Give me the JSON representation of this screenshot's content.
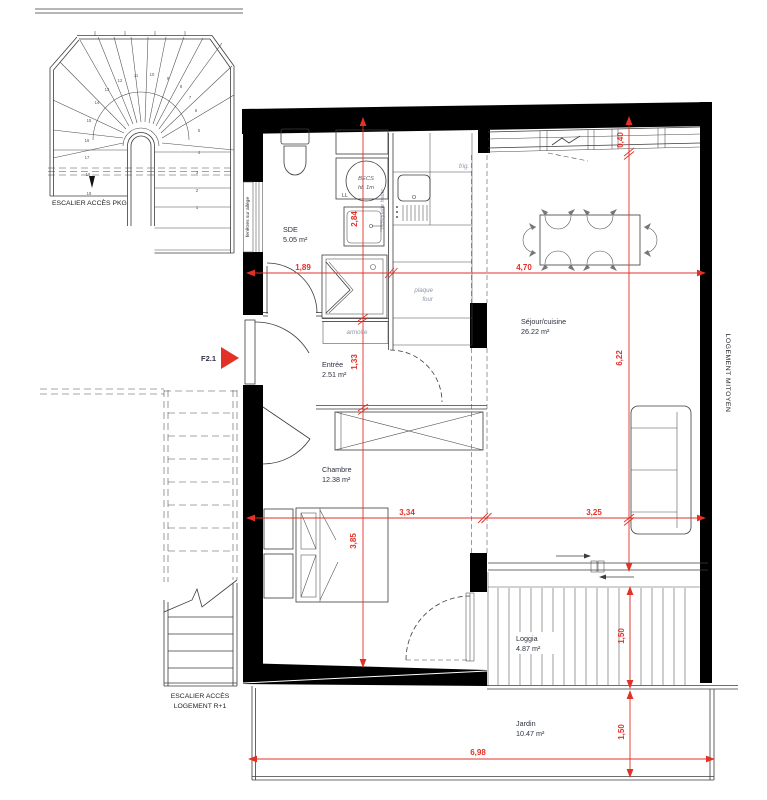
{
  "colors": {
    "dimension": "#e23127",
    "annotation": "#8d95a9",
    "room_text": "#2d3040",
    "wall": "#000000"
  },
  "stairs_pkg": {
    "label": "ESCALIER ACCÈS PKG",
    "steps": [
      "1",
      "2",
      "3",
      "4",
      "5",
      "6",
      "7",
      "8",
      "9",
      "10",
      "11",
      "12",
      "13",
      "14",
      "15",
      "16",
      "17",
      "18",
      "19"
    ]
  },
  "stairs_r1": {
    "label_line1": "ESCALIER ACCÈS",
    "label_line2": "LOGEMENT R+1"
  },
  "unit": {
    "entrance_label": "F2.1",
    "party_wall": "LOGEMENT MITOYEN",
    "window_sill": "fenêtres sur allège"
  },
  "rooms": {
    "sde": {
      "name": "SDE",
      "area": "5.05 m²"
    },
    "entree": {
      "name": "Entrée",
      "area": "2.51 m²"
    },
    "chambre": {
      "name": "Chambre",
      "area": "12.38 m²"
    },
    "sejour": {
      "name": "Séjour/cuisine",
      "area": "26.22 m²"
    },
    "loggia": {
      "name": "Loggia",
      "area": "4.87 m²"
    },
    "jardin": {
      "name": "Jardin",
      "area": "10.47 m²"
    }
  },
  "annotations": {
    "fridge": "frig.",
    "hob_line1": "plaque",
    "hob_line2": "four",
    "wardrobe": "armoire",
    "heater_line1": "BECS",
    "heater_line2": "ht. 1m",
    "washer": "LL",
    "tall_unit": "mosquette haute"
  },
  "dimensions": {
    "sde_width": "1,89",
    "sejour_width": "4,70",
    "sde_depth": "2,84",
    "entree_depth": "1,33",
    "chambre_width": "3,34",
    "sejour_width_lower": "3,25",
    "chambre_depth": "3,85",
    "sejour_depth": "6,22",
    "window_offset": "0,40",
    "loggia_depth": "1,50",
    "jardin_depth": "1,50",
    "total_width": "6,98"
  }
}
